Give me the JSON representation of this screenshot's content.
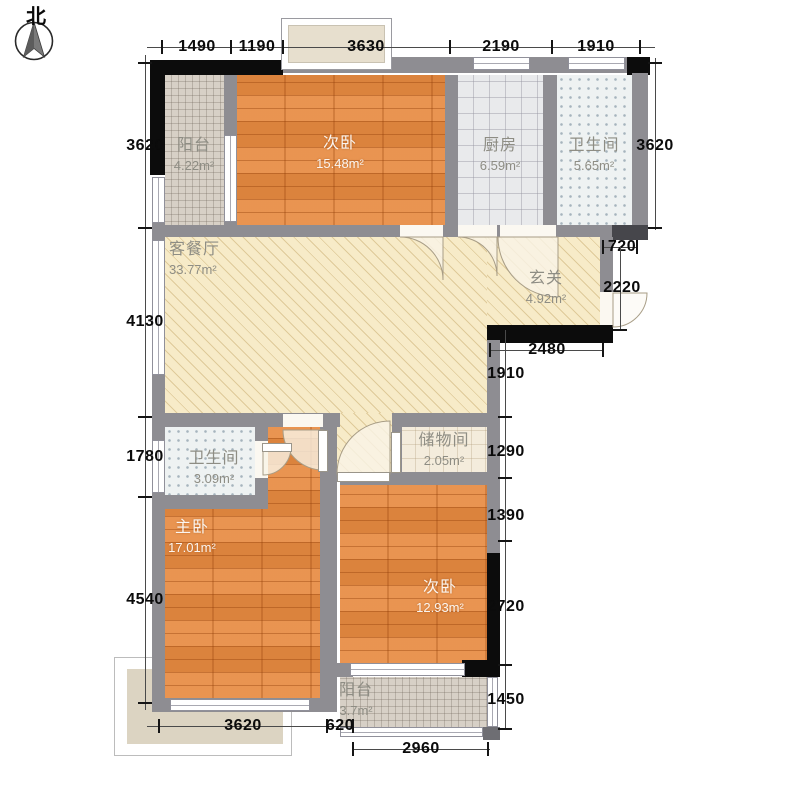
{
  "compass": {
    "north": "北"
  },
  "rooms": {
    "balcony_north": {
      "name": "阳台",
      "area": "4.22m²"
    },
    "bedroom_north": {
      "name": "次卧",
      "area": "15.48m²"
    },
    "kitchen": {
      "name": "厨房",
      "area": "6.59m²"
    },
    "bath_north": {
      "name": "卫生间",
      "area": "5.65m²"
    },
    "living": {
      "name": "客餐厅",
      "area": "33.77m²"
    },
    "foyer": {
      "name": "玄关",
      "area": "4.92m²"
    },
    "bath_south": {
      "name": "卫生间",
      "area": "3.09m²"
    },
    "storage": {
      "name": "储物间",
      "area": "2.05m²"
    },
    "master": {
      "name": "主卧",
      "area": "17.01m²"
    },
    "bedroom_south": {
      "name": "次卧",
      "area": "12.93m²"
    },
    "balcony_south": {
      "name": "阳台",
      "area": "3.7m²"
    }
  },
  "dims": {
    "top": [
      "1490",
      "1190",
      "3630",
      "2190",
      "1910"
    ],
    "left": [
      "3620",
      "4130",
      "1780",
      "4540"
    ],
    "right": {
      "d3620": "3620",
      "d720": "720",
      "d2220": "2220",
      "d2480": "2480",
      "d1910": "1910",
      "d1290": "1290",
      "d1390": "1390",
      "d2720": "2720",
      "d1450": "1450"
    },
    "bottom": [
      "3620",
      "620",
      "2960"
    ]
  },
  "colors": {
    "wall": "#8e8d92",
    "wall_accent": "#0c0c0c",
    "wood_floor": "#e78a40",
    "living_floor": "#f7ebc8",
    "balcony_tile": "#d7d0c6",
    "kitchen_tile": "#e9eaec",
    "bath_tile": "#eef2f2",
    "storage_floor": "#f4ecdc",
    "terrace": "#dcd4c2"
  }
}
